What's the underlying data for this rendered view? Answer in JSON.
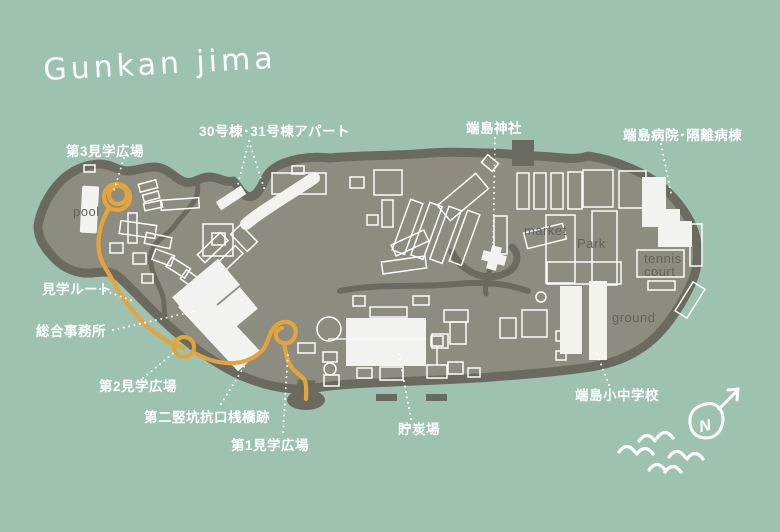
{
  "title": "Gunkan jima",
  "colors": {
    "ocean": "#9ec2b0",
    "island_fill": "#8d8c81",
    "island_outline": "#6b6a60",
    "building_fill": "#f2f2ef",
    "building_stroke": "#fcfcfa",
    "route_orange": "#e4a43b",
    "label_white": "#ffffff",
    "label_gray": "#63625a"
  },
  "labels": {
    "plaza3": "第3見学広場",
    "apartments": "30号棟･31号棟アパート",
    "shrine": "端島神社",
    "hospital": "端島病院･隔離病棟",
    "route": "見学ルート",
    "office": "総合事務所",
    "plaza2": "第2見学広場",
    "shaft_pier": "第二竪坑抗口桟橋跡",
    "plaza1": "第1見学広場",
    "coal_yard": "貯炭場",
    "school": "端島小中学校"
  },
  "places": {
    "pool": "pool",
    "market": "market",
    "park": "Park",
    "tennis_line1": "tennis",
    "tennis_line2": "court",
    "ground": "ground"
  },
  "compass": {
    "letter": "N"
  }
}
